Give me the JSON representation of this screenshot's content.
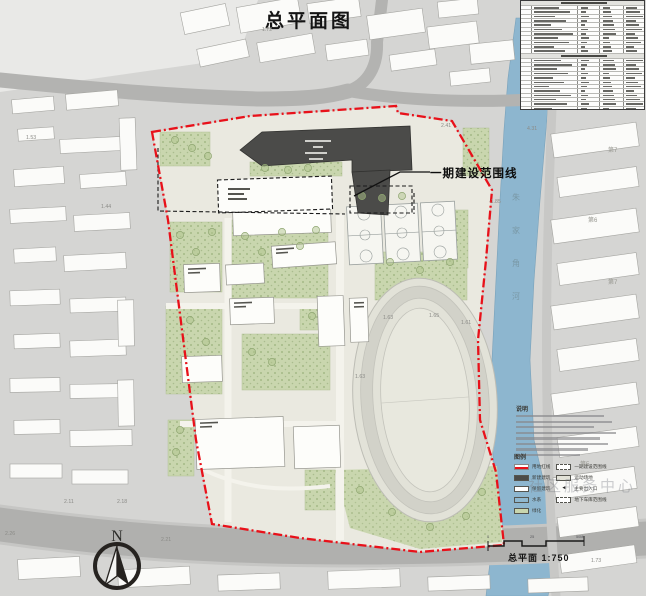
{
  "title": "总平面图",
  "phase_boundary_label": "一期建设范围线",
  "scale_label": "总平面 1:750",
  "north_label": "N",
  "notes_title": "说明",
  "legend_title": "图例",
  "legend_left": [
    {
      "key": "site-red-line",
      "label": "用地红线",
      "color": "#e8111a"
    },
    {
      "key": "new-building",
      "label": "新建建筑",
      "color": "#4b4b49"
    },
    {
      "key": "existing-building",
      "label": "保留建筑",
      "color": "#ffffff"
    },
    {
      "key": "water",
      "label": "水系",
      "color": "#8fb8d0"
    },
    {
      "key": "greenery",
      "label": "绿化",
      "color": "#c9d6ae"
    }
  ],
  "legend_right": [
    {
      "key": "phase1-line",
      "label": "一期建设范围线",
      "color": "#ffffff"
    },
    {
      "key": "sports-ground",
      "label": "运动场地",
      "color": "#e2e2d8"
    },
    {
      "key": "main-entrance",
      "label": "主要出入口",
      "color": "#222222"
    },
    {
      "key": "basement-line",
      "label": "地下车库范围线",
      "color": "#ffffff"
    }
  ],
  "indicator_table": {
    "row_count": 32,
    "section_row_indexes": [
      0,
      12,
      25
    ]
  },
  "river_name_chars": [
    "朱",
    "家",
    "角",
    "河"
  ],
  "scale_ticks": [
    {
      "label": "0",
      "x": 487,
      "y": 535
    },
    {
      "label": "25",
      "x": 530,
      "y": 535
    },
    {
      "label": "50M",
      "x": 576,
      "y": 535
    }
  ],
  "spot_elevations": [
    {
      "label": "1.72",
      "x": 262,
      "y": 27
    },
    {
      "label": "2.41",
      "x": 441,
      "y": 123
    },
    {
      "label": "4.31",
      "x": 527,
      "y": 126
    },
    {
      "label": "-1.85",
      "x": 489,
      "y": 199
    },
    {
      "label": "1.53",
      "x": 26,
      "y": 135
    },
    {
      "label": "1.44",
      "x": 101,
      "y": 204
    },
    {
      "label": "1.63",
      "x": 383,
      "y": 315
    },
    {
      "label": "1.65",
      "x": 429,
      "y": 313
    },
    {
      "label": "1.61",
      "x": 461,
      "y": 320
    },
    {
      "label": "1.63",
      "x": 355,
      "y": 374
    },
    {
      "label": "2.11",
      "x": 64,
      "y": 499
    },
    {
      "label": "2.18",
      "x": 117,
      "y": 499
    },
    {
      "label": "2.26",
      "x": 5,
      "y": 531
    },
    {
      "label": "2.21",
      "x": 161,
      "y": 537
    },
    {
      "label": "1.73",
      "x": 591,
      "y": 558
    }
  ],
  "district_labels": [
    {
      "label": "第7",
      "x": 608,
      "y": 145
    },
    {
      "label": "第6",
      "x": 588,
      "y": 215
    },
    {
      "label": "第7",
      "x": 608,
      "y": 277
    },
    {
      "label": "第5",
      "x": 580,
      "y": 459
    }
  ],
  "watermark": "社区服务中心"
}
